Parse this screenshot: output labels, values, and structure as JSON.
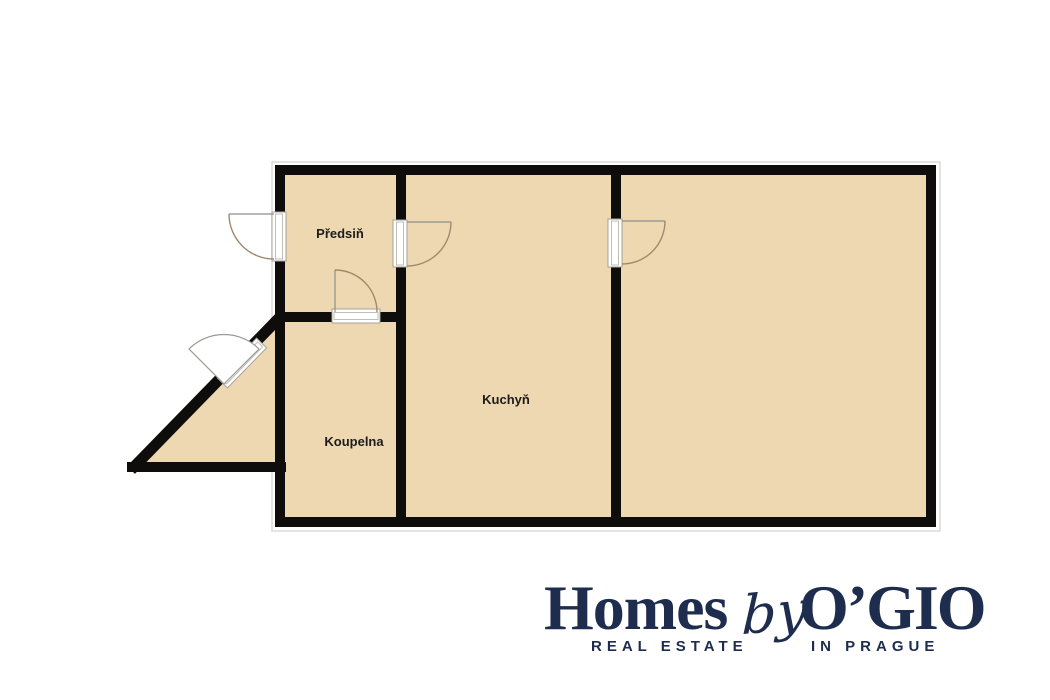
{
  "floorplan": {
    "rooms": {
      "hallway": {
        "label": "Předsiň"
      },
      "kitchen": {
        "label": "Kuchyň"
      },
      "bathroom": {
        "label": "Koupelna"
      }
    },
    "doors": [
      {
        "name": "entry-door-left-wall",
        "swing": "outward-left"
      },
      {
        "name": "door-hallway-to-kitchen",
        "swing": "into-kitchen"
      },
      {
        "name": "door-kitchen-to-room",
        "swing": "into-room"
      },
      {
        "name": "door-hallway-to-bathroom",
        "swing": "into-hallway"
      },
      {
        "name": "door-diagonal-wall",
        "swing": "outward"
      }
    ],
    "colors": {
      "floor": "#edd8b2",
      "wall": "#0e0d0b",
      "door_frame": "#ffffff",
      "door_frame_stroke": "#a6a29a",
      "door_arc": "#a18a6c",
      "label": "#1c1c1c",
      "outline": "#dbdbd8"
    }
  },
  "logo": {
    "word_homes": "Homes",
    "word_by": "by",
    "word_ogio": "O’GIO",
    "tagline_left": "REAL ESTATE",
    "tagline_right": "IN PRAGUE",
    "color": "#1e2c4d"
  }
}
